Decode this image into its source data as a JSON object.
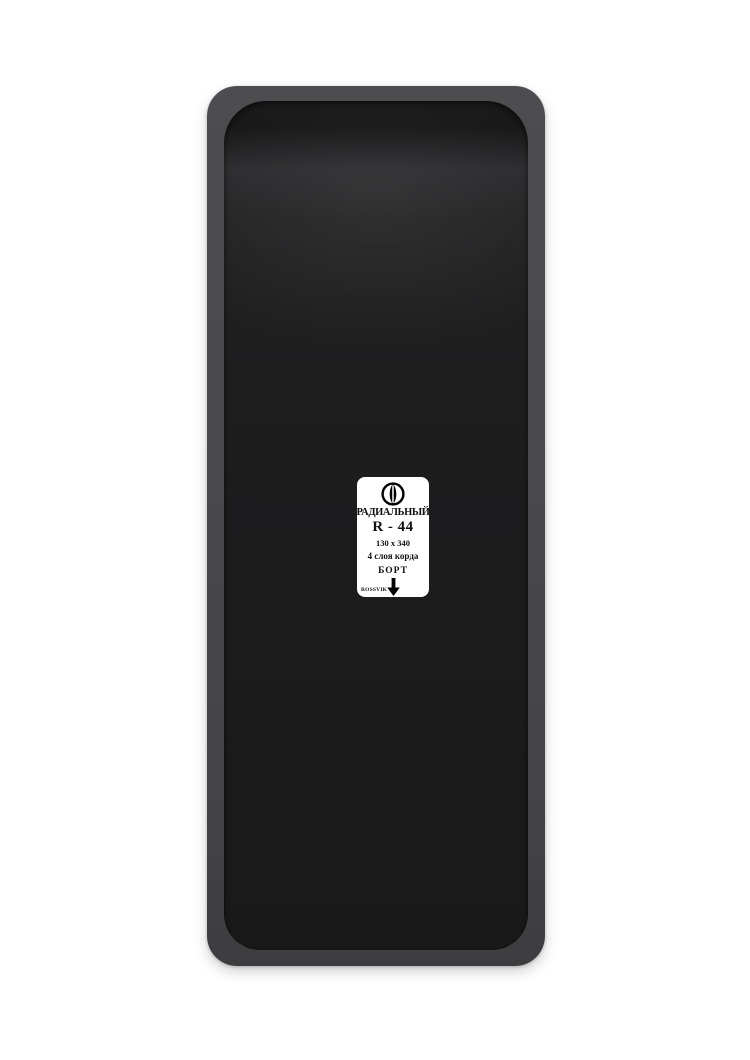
{
  "product": {
    "brand": "ROSSVIK",
    "label": {
      "type": "РАДИАЛЬНЫЙ",
      "model": "R - 44",
      "size": "130 x 340",
      "plies": "4 слоя корда",
      "bead": "БОРТ"
    }
  },
  "icons": {
    "emblem": "rossvik-emblem-icon",
    "arrow": "bead-direction-down-arrow-icon"
  },
  "colors": {
    "background": "#ffffff",
    "patch_frame_gray": "#48484b",
    "patch_rubber_black": "#1c1c1d",
    "label_background": "#ffffff",
    "label_text": "#111111"
  }
}
